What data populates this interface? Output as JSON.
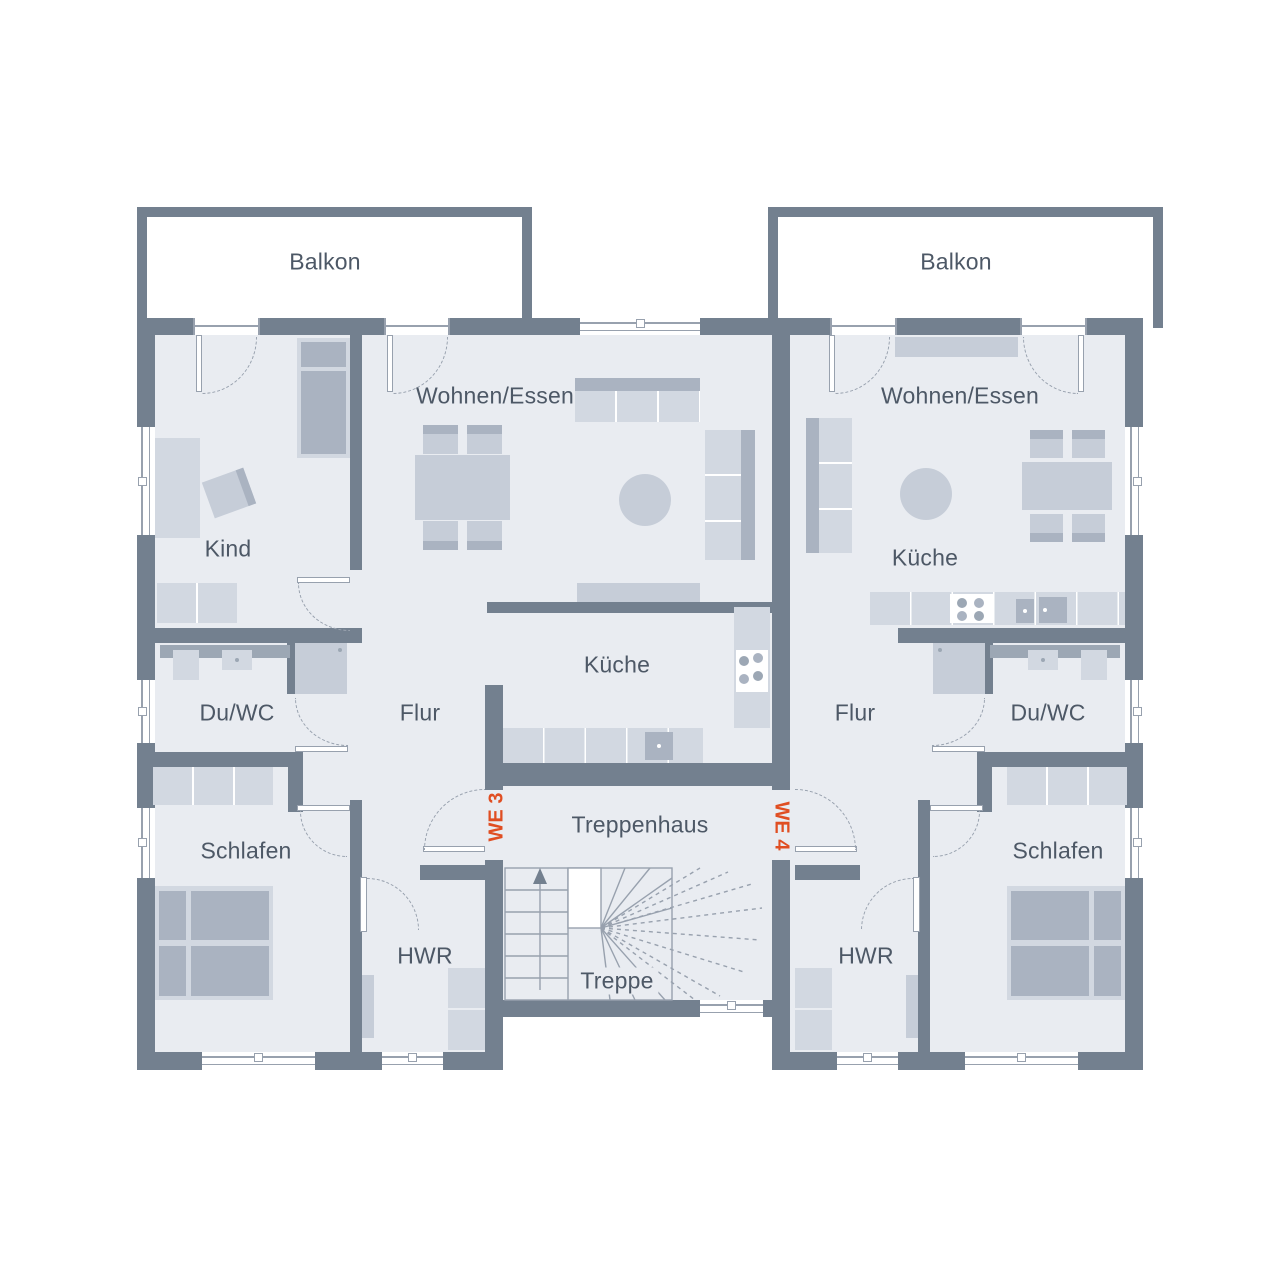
{
  "plan": {
    "type": "floor-plan",
    "rooms": {
      "balcony": "Balkon",
      "living": "Wohnen/Essen",
      "child": "Kind",
      "kitchen": "Küche",
      "bath": "Du/WC",
      "hall": "Flur",
      "bedroom": "Schlafen",
      "utility": "HWR",
      "stairwell": "Treppenhaus",
      "stairs": "Treppe"
    },
    "unit_markers": {
      "left": "WE 3",
      "right": "WE 4"
    }
  },
  "colors": {
    "wall": "#73808f",
    "floor": "#e9ecf1",
    "outside": "#ffffff",
    "furniture_light": "#d2d8e1",
    "furniture_medium": "#c6cdd8",
    "furniture_dark": "#aab3c1",
    "fixture_band": "#9ca7b4",
    "accent": "#e04e22",
    "text": "#4d5866",
    "stair_line": "#98a1ae"
  }
}
